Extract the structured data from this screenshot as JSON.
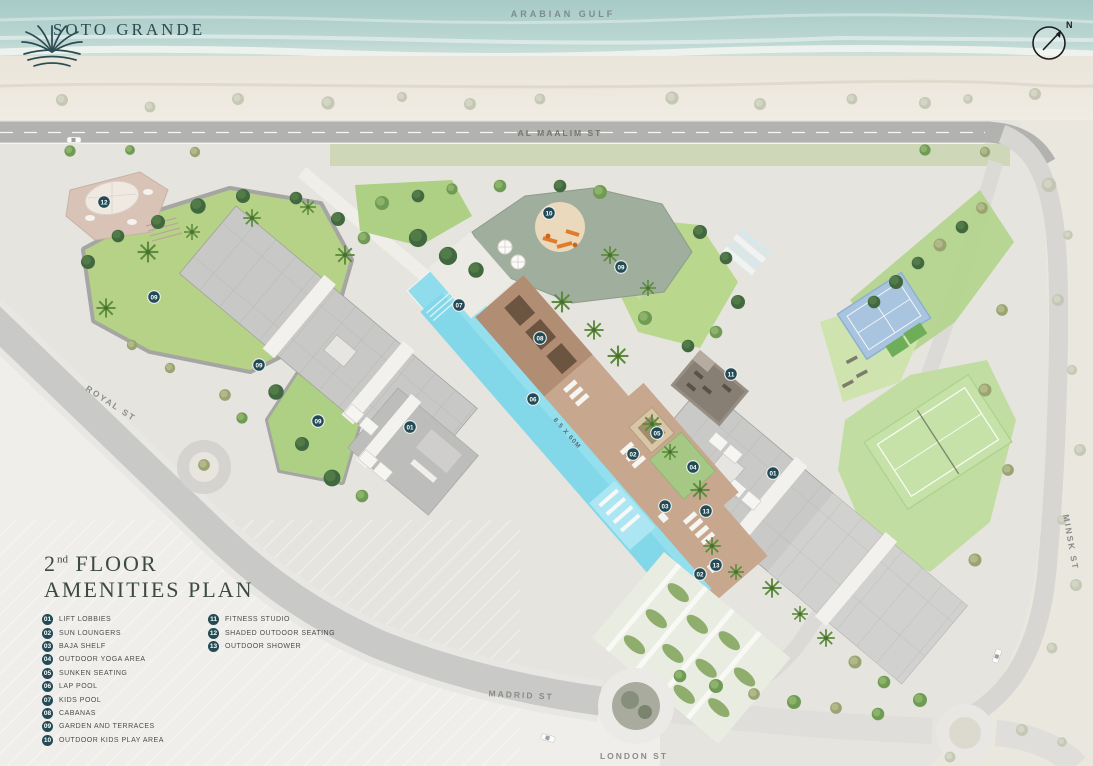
{
  "brand": {
    "name": "SOTO GRANDE",
    "emblem_icon": "palm-sun-emblem"
  },
  "compass": {
    "north_label": "N"
  },
  "water": {
    "label": "ARABIAN GULF"
  },
  "title": {
    "floor_number": "2",
    "floor_ordinal": "nd",
    "floor_text": "FLOOR",
    "line2": "AMENITIES PLAN"
  },
  "streets": {
    "al_maalim": "AL MAALIM ST",
    "royal": "ROYAL ST",
    "minsk": "MINSK ST",
    "madrid": "MADRID ST",
    "london": "LONDON ST"
  },
  "pool": {
    "dimension_label": "8.5 X 60M"
  },
  "legend": {
    "items": [
      {
        "num": "01",
        "label": "LIFT LOBBIES"
      },
      {
        "num": "02",
        "label": "SUN LOUNGERS"
      },
      {
        "num": "03",
        "label": "BAJA SHELF"
      },
      {
        "num": "04",
        "label": "OUTDOOR YOGA AREA"
      },
      {
        "num": "05",
        "label": "SUNKEN SEATING"
      },
      {
        "num": "06",
        "label": "LAP POOL"
      },
      {
        "num": "07",
        "label": "KIDS POOL"
      },
      {
        "num": "08",
        "label": "CABANAS"
      },
      {
        "num": "09",
        "label": "GARDEN AND TERRACES"
      },
      {
        "num": "10",
        "label": "OUTDOOR KIDS PLAY AREA"
      },
      {
        "num": "11",
        "label": "FITNESS STUDIO"
      },
      {
        "num": "12",
        "label": "SHADED OUTDOOR SEATING"
      },
      {
        "num": "13",
        "label": "OUTDOOR SHOWER"
      }
    ]
  },
  "markers": [
    {
      "num": "12",
      "x": 104,
      "y": 202
    },
    {
      "num": "09",
      "x": 154,
      "y": 297
    },
    {
      "num": "09",
      "x": 259,
      "y": 365
    },
    {
      "num": "09",
      "x": 318,
      "y": 421
    },
    {
      "num": "01",
      "x": 410,
      "y": 427
    },
    {
      "num": "07",
      "x": 459,
      "y": 305
    },
    {
      "num": "10",
      "x": 549,
      "y": 213
    },
    {
      "num": "09",
      "x": 621,
      "y": 267
    },
    {
      "num": "08",
      "x": 540,
      "y": 338
    },
    {
      "num": "06",
      "x": 533,
      "y": 399
    },
    {
      "num": "11",
      "x": 731,
      "y": 374
    },
    {
      "num": "05",
      "x": 657,
      "y": 433
    },
    {
      "num": "02",
      "x": 633,
      "y": 454
    },
    {
      "num": "04",
      "x": 693,
      "y": 467
    },
    {
      "num": "01",
      "x": 773,
      "y": 473
    },
    {
      "num": "03",
      "x": 665,
      "y": 506
    },
    {
      "num": "13",
      "x": 706,
      "y": 511
    },
    {
      "num": "13",
      "x": 716,
      "y": 565
    },
    {
      "num": "02",
      "x": 700,
      "y": 574
    }
  ],
  "colors": {
    "badge": "#234b55",
    "pool_water": "#82d8e9",
    "lawn": "#b5d287",
    "deck_tan": "#c7a78e",
    "road": "#b2b2b0",
    "sea": "#aecfcb",
    "brand_teal": "#2b4c52"
  }
}
